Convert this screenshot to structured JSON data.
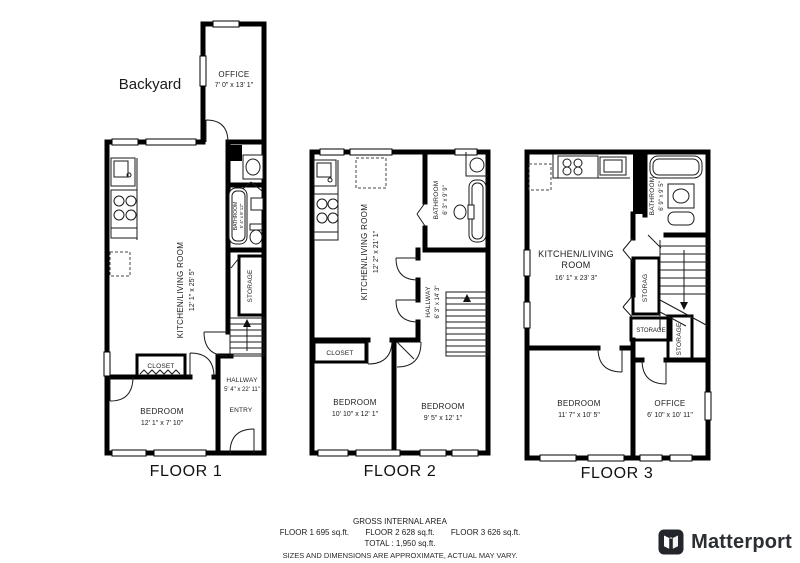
{
  "floors": [
    {
      "title": "FLOOR 1",
      "outdoor_label": "Backyard",
      "rooms": {
        "office": {
          "name": "OFFICE",
          "dims": "7' 0\" x 13' 1\""
        },
        "kitchen_living": {
          "name": "KITCHEN/LIVING ROOM",
          "dims": "12' 1\" x 25' 5\""
        },
        "bathroom": {
          "name": "BATHROOM",
          "dims": "5' 4\" x 8' 12\""
        },
        "storage": {
          "name": "STORAGE"
        },
        "closet": {
          "name": "CLOSET"
        },
        "hallway": {
          "name": "HALLWAY",
          "dims": "5' 4\" x 22' 11\""
        },
        "bedroom": {
          "name": "BEDROOM",
          "dims": "12' 1\" x 7' 10\""
        },
        "entry": {
          "name": "ENTRY"
        }
      }
    },
    {
      "title": "FLOOR 2",
      "rooms": {
        "kitchen_living": {
          "name": "KITCHEN/LIVING ROOM",
          "dims": "12' 2\" x 21' 1\""
        },
        "bathroom": {
          "name": "BATHROOM",
          "dims": "6' 3\" x 9' 9\""
        },
        "hallway": {
          "name": "HALLWAY",
          "dims": "6' 3\" x 14' 3\""
        },
        "closet": {
          "name": "CLOSET"
        },
        "bedroom_left": {
          "name": "BEDROOM",
          "dims": "10' 10\" x 12' 1\""
        },
        "bedroom_right": {
          "name": "BEDROOM",
          "dims": "9' 5\" x 12' 1\""
        }
      }
    },
    {
      "title": "FLOOR 3",
      "rooms": {
        "kitchen_living": {
          "name_line1": "KITCHEN/LIVING",
          "name_line2": "ROOM",
          "dims": "16' 1\" x 23' 3\""
        },
        "bathroom": {
          "name": "BATHROOM",
          "dims": "6' 9\" x 9' 5\""
        },
        "storage_upper": {
          "name": "STORAG"
        },
        "storage_mid": {
          "name": "STORAGE"
        },
        "storage_lower": {
          "name": "STORAGE"
        },
        "bedroom": {
          "name": "BEDROOM",
          "dims": "11' 7\" x 10' 5\""
        },
        "office": {
          "name": "OFFICE",
          "dims": "6' 10\" x 10' 11\""
        }
      }
    }
  ],
  "footer": {
    "title": "GROSS INTERNAL AREA",
    "floor_areas": [
      "FLOOR 1 695 sq.ft.",
      "FLOOR 2 628 sq.ft.",
      "FLOOR 3 626 sq.ft."
    ],
    "total": "TOTAL :  1,950 sq.ft.",
    "disclaimer": "SIZES AND DIMENSIONS ARE APPROXIMATE, ACTUAL MAY VARY."
  },
  "brand": {
    "name": "Matterport"
  },
  "colors": {
    "wall": "#000000",
    "text": "#1c1c1c",
    "logo_dark": "#22262b"
  }
}
